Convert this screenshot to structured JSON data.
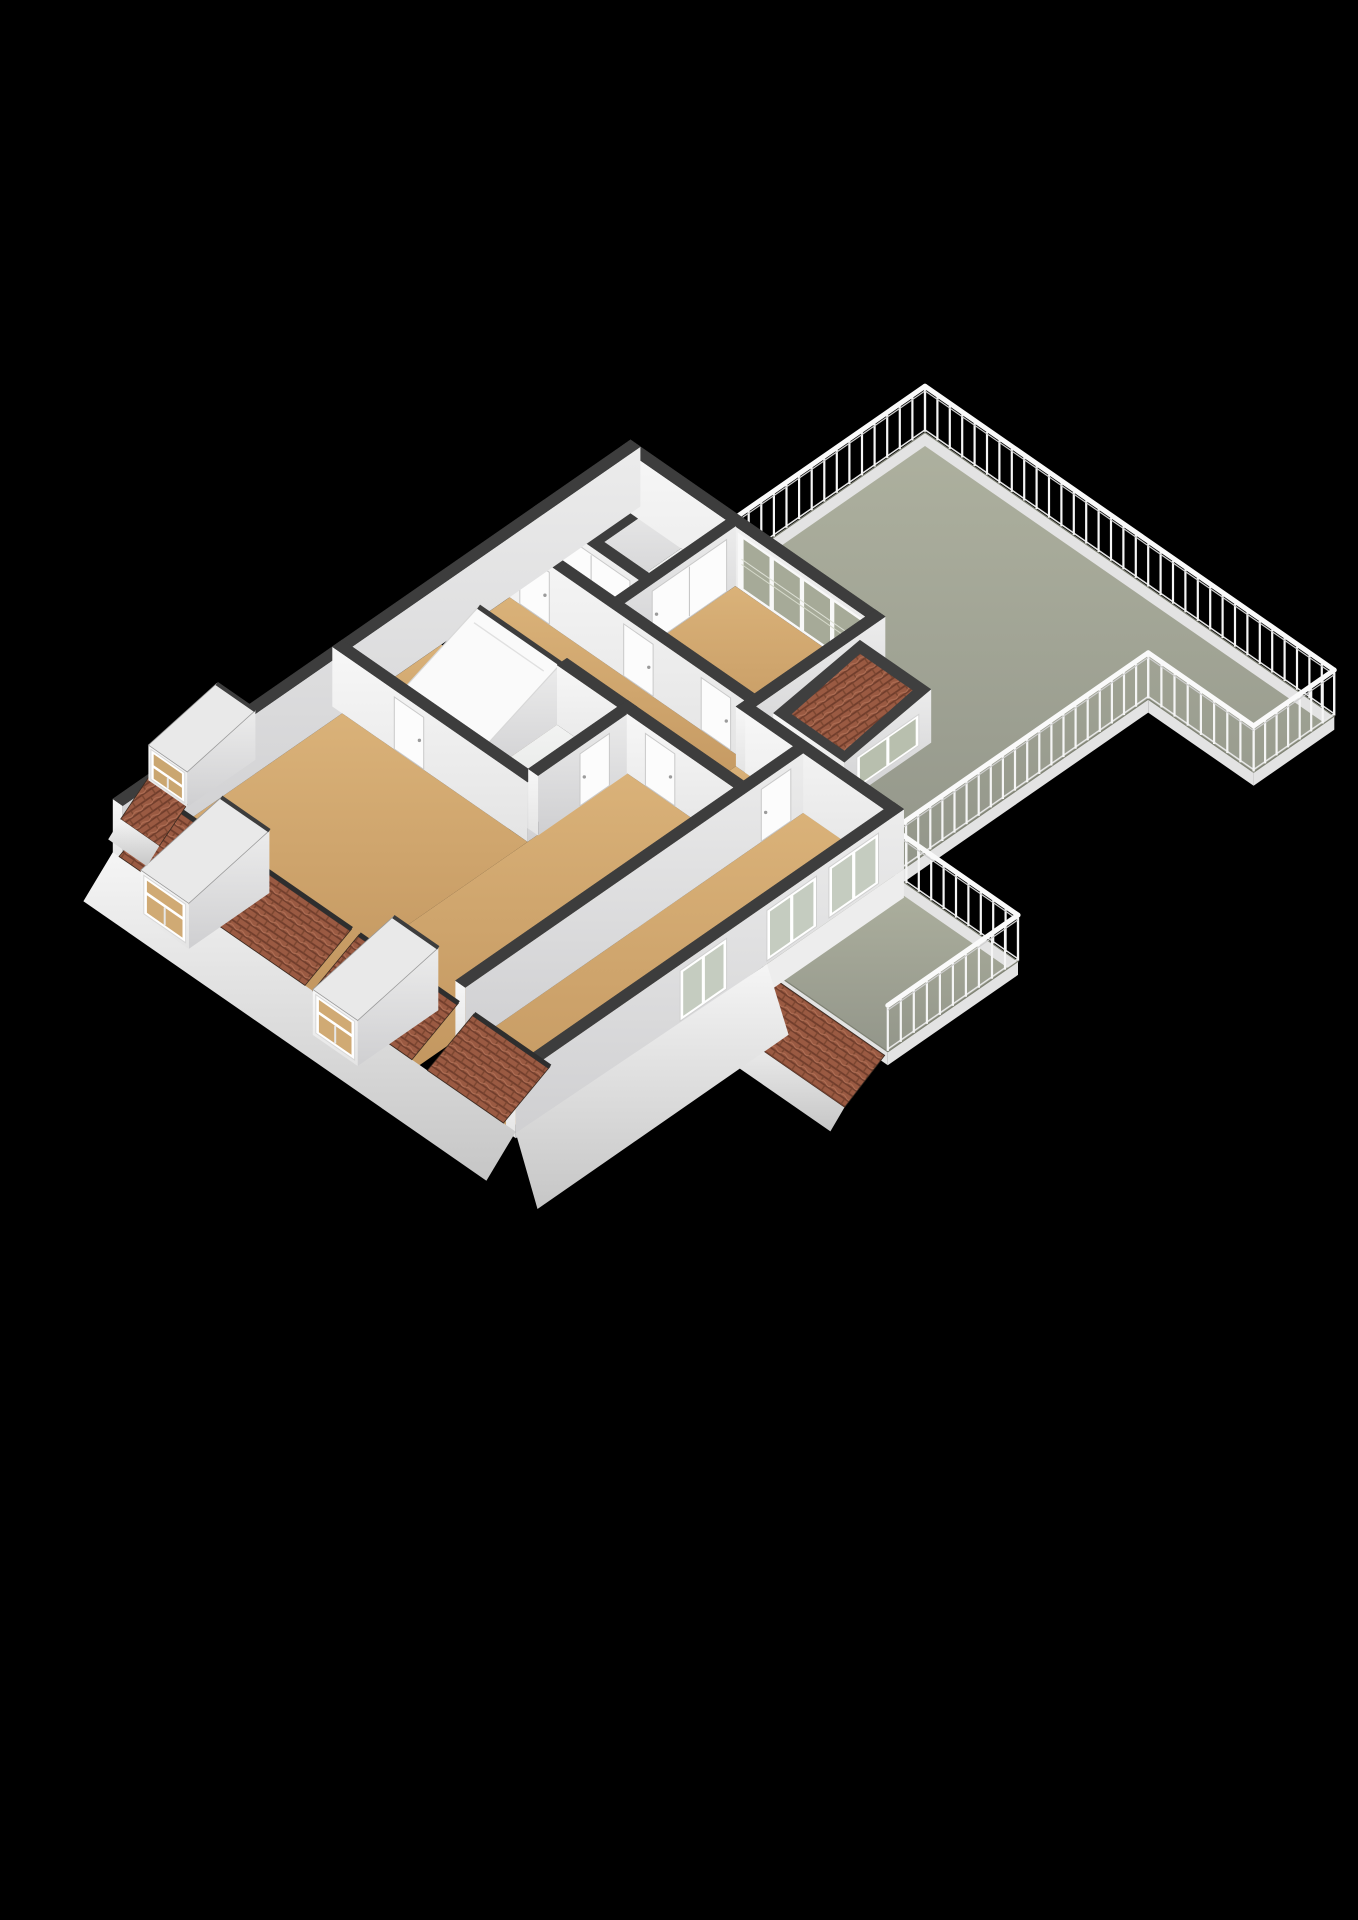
{
  "meta": {
    "kind": "floorplan-3d-render",
    "storey": "attic-with-roof-terrace"
  },
  "projection": {
    "ox": 925,
    "oy": 433,
    "ax": 31,
    "by": 21.5,
    "zk": 26,
    "wallH": 2.3,
    "railH": 1.8
  },
  "colors": {
    "bg": "#000000",
    "wallTop": "#3d3d3d",
    "dark": "#2e2e2e",
    "floorWhite": "#eef0ef",
    "terrEdge": "#7f8274",
    "curb": "#e3e3e3",
    "rail": "#fafafa",
    "railShadow": "#cfcfcf",
    "post": "#f5f5f5",
    "glass": "#c5ccc0",
    "glassTerr": "#a6aa98",
    "door": "#fcfcfc",
    "doorEdge": "#c9c9c9",
    "handle": "#9b9b9b",
    "tileBase": "#9a5a42",
    "tileLine": "#6f3c2b",
    "tileHi": "#b06f55",
    "dormerTop": "#e9e9e9",
    "skylight": "#fafafa"
  },
  "terrace": {
    "floor1": [
      [
        0,
        0
      ],
      [
        13.2,
        0
      ],
      [
        13.2,
        2.6
      ],
      [
        9.8,
        2.6
      ],
      [
        9.8,
        10.8
      ],
      [
        5,
        10.8
      ],
      [
        5,
        6.5
      ],
      [
        0,
        6.5
      ]
    ],
    "floor2": [
      [
        9.8,
        10.8
      ],
      [
        13.8,
        10.8
      ],
      [
        13.8,
        15
      ],
      [
        9.8,
        15
      ]
    ],
    "railings": [
      [
        [
          0,
          6.5
        ],
        [
          0,
          0
        ]
      ],
      [
        [
          0,
          0
        ],
        [
          13.2,
          0
        ]
      ],
      [
        [
          13.2,
          0
        ],
        [
          13.2,
          2.6
        ]
      ],
      [
        [
          13.2,
          2.6
        ],
        [
          9.8,
          2.6
        ]
      ],
      [
        [
          9.8,
          2.6
        ],
        [
          9.8,
          10.8
        ]
      ],
      [
        [
          9.8,
          10.8
        ],
        [
          13.8,
          10.8
        ]
      ],
      [
        [
          13.8,
          10.8
        ],
        [
          13.8,
          15
        ]
      ]
    ],
    "curbs": [
      [
        [
          0,
          6.5
        ],
        [
          0,
          0
        ]
      ],
      [
        [
          0,
          0
        ],
        [
          13.2,
          0
        ]
      ],
      [
        [
          13.2,
          0
        ],
        [
          13.2,
          2.6
        ]
      ],
      [
        [
          13.2,
          2.6
        ],
        [
          9.8,
          2.6
        ]
      ],
      [
        [
          9.8,
          2.6
        ],
        [
          9.8,
          10.8
        ]
      ],
      [
        [
          9.8,
          10.8
        ],
        [
          13.8,
          10.8
        ]
      ],
      [
        [
          13.8,
          10.8
        ],
        [
          13.8,
          15
        ]
      ],
      [
        [
          13.8,
          15
        ],
        [
          9.8,
          15
        ]
      ]
    ],
    "lowerRoofTiles": [
      [
        9.9,
        15.05,
        -0.12
      ],
      [
        13.75,
        15.05,
        -0.12
      ],
      [
        13.75,
        16.35,
        -1.05
      ],
      [
        9.9,
        16.35,
        -1.05
      ]
    ],
    "lowerRoofFascia": [
      [
        9.9,
        16.35,
        -1.05
      ],
      [
        13.75,
        16.35,
        -1.05
      ],
      [
        13.75,
        16.8,
        -1.6
      ],
      [
        9.9,
        16.8,
        -1.6
      ]
    ]
  },
  "building": {
    "floors": [
      {
        "name": "closet-1",
        "fill": "white",
        "r": [
          -2.88,
          6.62,
          -1.55,
          9.1
        ]
      },
      {
        "name": "closet-2",
        "fill": "white",
        "r": [
          -1.25,
          6.62,
          0.2,
          9.1
        ]
      },
      {
        "name": "bedroom-a",
        "fill": "tan",
        "r": [
          0.5,
          6.62,
          4.7,
          10.2
        ]
      },
      {
        "name": "hallway",
        "fill": "tan",
        "r": [
          -2.88,
          10.52,
          4.7,
          12.4
        ]
      },
      {
        "name": "hallway-e",
        "fill": "tan",
        "r": [
          4.7,
          10.8,
          6.55,
          12.4
        ]
      },
      {
        "name": "landing",
        "fill": "tan",
        "r": [
          -2.88,
          12.72,
          0.85,
          15.6
        ]
      },
      {
        "name": "bathroom",
        "fill": "white",
        "r": [
          0.85,
          12.72,
          2.8,
          15.6
        ]
      },
      {
        "name": "bedroom-b",
        "fill": "tan",
        "r": [
          -2.88,
          15.92,
          3.1,
          23
        ]
      },
      {
        "name": "bedroom-c",
        "fill": "tan",
        "r": [
          3.1,
          12.72,
          6.55,
          23
        ]
      },
      {
        "name": "bedroom-d",
        "fill": "tan",
        "r": [
          6.87,
          10.8,
          9.48,
          23
        ]
      }
    ],
    "order": [
      "w_cl_div",
      "w_ne",
      "w_cl_front",
      "w_bedA_w",
      "w_hallN",
      "w_nw",
      "stair",
      "w_me",
      "terraceDormer",
      "w_bathN",
      "w_bB_N",
      "w_bathE",
      "w_bC_N",
      "w_wn",
      "w_CD",
      "w_se"
    ],
    "walls": {
      "w_cl_div": {
        "r": [
          -1.55,
          6.6,
          -1.25,
          9.4
        ]
      },
      "w_ne": {
        "r": [
          -3.2,
          6.3,
          5.0,
          6.62
        ],
        "glazing": {
          "x0": 0.7,
          "x1": 4.6,
          "z0": 0.06,
          "z1": 2.08,
          "panes": 4
        }
      },
      "w_cl_front": {
        "r": [
          -3.2,
          9.1,
          0.2,
          9.42
        ],
        "doors": [
          {
            "face": "y",
            "a": -2.6,
            "b": -0.1,
            "split": 2
          }
        ]
      },
      "w_bedA_w": {
        "r": [
          0.2,
          6.6,
          0.5,
          10.2
        ],
        "doors": [
          {
            "face": "x",
            "a": 6.9,
            "b": 9.3,
            "split": 2
          }
        ]
      },
      "w_hallN": {
        "r": [
          -2.88,
          10.2,
          4.7,
          10.52
        ],
        "doors": [
          {
            "face": "y",
            "a": -2.55,
            "b": -1.6
          },
          {
            "face": "y",
            "a": 0.8,
            "b": 1.75
          },
          {
            "face": "y",
            "a": 3.3,
            "b": 4.25
          }
        ]
      },
      "w_nw": {
        "r": [
          -3.2,
          6.3,
          -2.88,
          23
        ]
      },
      "w_me": {
        "r": [
          4.7,
          6.3,
          5.02,
          10.8
        ]
      },
      "w_bathN": {
        "r": [
          0.85,
          12.4,
          3.1,
          12.72
        ]
      },
      "w_bB_N": {
        "r": [
          -3.2,
          15.6,
          3.1,
          15.92
        ],
        "doors": [
          {
            "face": "y",
            "a": -1.2,
            "b": -0.25
          }
        ]
      },
      "w_bathE": {
        "r": [
          2.8,
          12.4,
          3.12,
          15.6
        ],
        "doors": [
          {
            "face": "x",
            "a": 13.3,
            "b": 14.25
          }
        ]
      },
      "w_bC_N": {
        "r": [
          3.1,
          12.4,
          6.55,
          12.72
        ],
        "doors": [
          {
            "face": "y",
            "a": 3.7,
            "b": 4.65
          }
        ]
      },
      "w_wn": {
        "r": [
          5.0,
          10.48,
          9.8,
          10.8
        ]
      },
      "w_CD": {
        "r": [
          6.55,
          10.8,
          6.87,
          21.7
        ],
        "doors": [
          {
            "face": "x",
            "a": 11.2,
            "b": 12.15
          }
        ]
      },
      "w_se": {
        "r": [
          9.48,
          10.48,
          9.8,
          23
        ],
        "windows": [
          [
            11.3,
            12.9
          ],
          [
            13.3,
            14.9
          ],
          [
            16.2,
            17.7
          ]
        ]
      }
    },
    "stair": {
      "r": [
        -1.8,
        12.6,
        0.85,
        15.3
      ],
      "zHigh": 2.25,
      "zLow": 0.95
    },
    "terraceDormer": {
      "r": [
        5.0,
        7.1,
        7.3,
        9.9
      ],
      "zNE": 2.05,
      "zSW": 1.55,
      "win": {
        "y0": 7.5,
        "y1": 9.5,
        "z0": 0.22,
        "z1": 1.42
      }
    },
    "eaves": {
      "yIn": 21.5,
      "yOut": 23.0,
      "zTop": 1.18,
      "zLow": 0.25,
      "tiles": [
        [
          -3.0,
          -1.75
        ],
        [
          -0.05,
          3.0
        ],
        [
          3.25,
          3.8
        ],
        [
          5.35,
          6.45
        ],
        [
          6.95,
          9.4
        ]
      ],
      "fascia": {
        "x0": -3.2,
        "x1": 9.8,
        "y1": 23.95,
        "z1": -0.85
      },
      "seFascia": [
        [
          9.8,
          14.9,
          0
        ],
        [
          9.8,
          23,
          0.2
        ],
        [
          11.1,
          23.6,
          -1.15
        ],
        [
          11.1,
          15.5,
          -1.15
        ]
      ],
      "seSkirt": [
        [
          9.8,
          10.48,
          0
        ],
        [
          9.8,
          15,
          0
        ],
        [
          9.8,
          15,
          -1.1
        ],
        [
          9.8,
          10.48,
          -1.1
        ]
      ]
    },
    "dormersSW": [
      {
        "x0": -1.7,
        "x1": -0.15,
        "y0": 21.0,
        "y1": 23.6,
        "h": 1.95
      },
      {
        "x0": 3.85,
        "x1": 5.3,
        "y0": 21.0,
        "y1": 23.6,
        "h": 1.95
      }
    ],
    "dormerNW": {
      "x0": -4.45,
      "x1": -3.2,
      "y0": 18.4,
      "y1": 20.6,
      "h": 1.9,
      "tiles": [
        [
          -4.45,
          20.6,
          0.1
        ],
        [
          -3.2,
          20.6,
          0.1
        ],
        [
          -3.2,
          21.5,
          -0.75
        ],
        [
          -4.45,
          21.5,
          -0.75
        ]
      ],
      "fascia": [
        [
          -4.45,
          21.5,
          -0.75
        ],
        [
          -3.2,
          21.5,
          -0.75
        ],
        [
          -3.2,
          21.9,
          -1.2
        ],
        [
          -4.45,
          21.9,
          -1.2
        ]
      ]
    }
  }
}
